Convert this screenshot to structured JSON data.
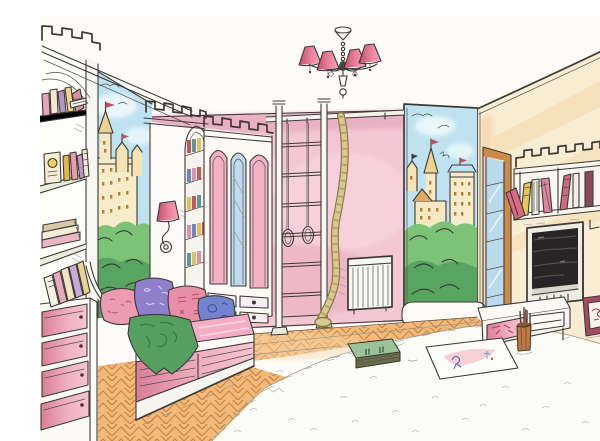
{
  "meta": {
    "description": "Hand-drawn watercolor sketch of a children's room with castle murals and castle-shaped furniture",
    "visible_text": "none (illustration only, faint artist stamp bottom-right)"
  },
  "palette": {
    "paper": "#fdfcf9",
    "ink": "#3d3a36",
    "wall_pink": "#f3c7d4",
    "wall_pink_deep": "#e7a5bb",
    "side_wall": "#f8ecd2",
    "side_streak": "#f3cf97",
    "sky": "#bfe2f0",
    "foliage": "#7cc378",
    "foliage_dark": "#3f9150",
    "castle_wall": "#f7ecca",
    "castle_trim": "#ecd392",
    "window_dot": "#b5803c",
    "parquet": "#f1ba7a",
    "parquet_line": "#c9823f",
    "rug": "#fcfcf7",
    "rug_mark": "#b5b2a6",
    "mattress": "#f3aec6",
    "drawer_pink": "#f6c4d2",
    "drawer_deep": "#d97e98",
    "panel_pink": "#f3b1c6",
    "panel_blue": "#bedbed",
    "pillow_pink": "#eb9cb2",
    "pillow_purple": "#8f7fca",
    "pillow_rose": "#e78fa6",
    "pillow_blue": "#7383cd",
    "throw_green": "#55a061",
    "shade_dark": "#c24e6b",
    "shade_light": "#f2a8bb",
    "rope": "#d9c98e",
    "tv_black": "#272525",
    "frame_maroon": "#a34b60",
    "wood": "#cf8a4a",
    "glass_blue": "#b9d9ec"
  },
  "objects": {
    "chandelier": "ceiling chandelier with four pink shades",
    "left_bookcase": "white bookcase with colorful books",
    "castle_mural_left": "castle and forest mural, left wall",
    "castle_mural_right": "castle and forest mural, right of back wall",
    "column_sconce": "wall sconce with pink shade on crenellated column",
    "arched_bookshelf": "narrow arched niche with small books",
    "wardrobe": "white wardrobe with pink and blue arched door panels",
    "wall_bars": "gymnastic wall bars with rings and climbing rope",
    "radiator": "white panel radiator",
    "bench": "white bench cushion under right mural",
    "glass_door": "tall glazed door in the corner",
    "castle_shelf": "crenellated castle wall shelf with books",
    "sconce_right": "wall sconce with pink shade, right wall",
    "tv": "flat TV in dark wall niche",
    "desk": "low white cabinet with pink drawer",
    "pencil_cup": "cup with pencils on the floor",
    "picture_frames": "two maroon picture frames leaning on wall",
    "sofa": "daybed sofa with pillows, green throw and drawers",
    "chest": "chest of drawers with pink fronts",
    "rug": "white shaggy rug",
    "parquet": "herringbone parquet floor",
    "floor_book": "green book lying on rug",
    "floor_sheet": "child's drawing sheet on rug",
    "watermark": "faint artist stamp"
  }
}
